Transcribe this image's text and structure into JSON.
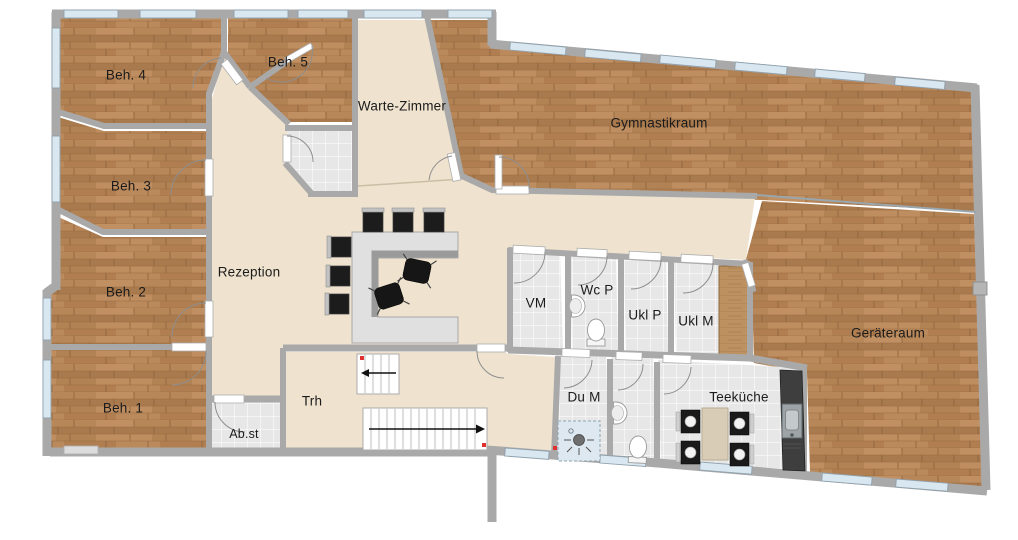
{
  "page": {
    "type": "floor-plan",
    "description": "practice floor plan"
  },
  "rooms": {
    "beh1": {
      "label": "Beh. 1"
    },
    "beh2": {
      "label": "Beh. 2"
    },
    "beh3": {
      "label": "Beh. 3"
    },
    "beh4": {
      "label": "Beh. 4"
    },
    "beh5": {
      "label": "Beh. 5"
    },
    "warte_zimmer": {
      "label": "Warte-Zimmer"
    },
    "gymnastikraum": {
      "label": "Gymnastikraum"
    },
    "rezeption": {
      "label": "Rezeption"
    },
    "geraeteraum": {
      "label": "Geräteraum"
    },
    "vm": {
      "label": "VM"
    },
    "wc_p": {
      "label": "Wc P"
    },
    "ukl_p": {
      "label": "Ukl P"
    },
    "ukl_m": {
      "label": "Ukl M"
    },
    "du_m": {
      "label": "Du M"
    },
    "teekueche": {
      "label": "Teeküche"
    },
    "trh": {
      "label": "Trh"
    },
    "abst": {
      "label": "Ab.st"
    }
  },
  "colors": {
    "wall": "#A9A9A9",
    "wood_floor": "#B28055",
    "beige_floor": "#EFE3CF",
    "tile_floor": "#E7E7E7",
    "window": "#D8E7F0",
    "furniture_dark": "#1A1A1A",
    "desk": "#E0E0E0",
    "counter": "#3E3E3E",
    "marker_red": "#E03030"
  },
  "icons": {
    "stair_long": "arrow-right-icon",
    "stair_short": "arrow-left-icon",
    "toilet": "toilet-icon",
    "sink": "sink-icon",
    "shower": "shower-icon",
    "kitchen_sink": "kitchen-sink-icon",
    "office_chair": "office-chair-icon",
    "waiting_chair": "chair-icon"
  }
}
